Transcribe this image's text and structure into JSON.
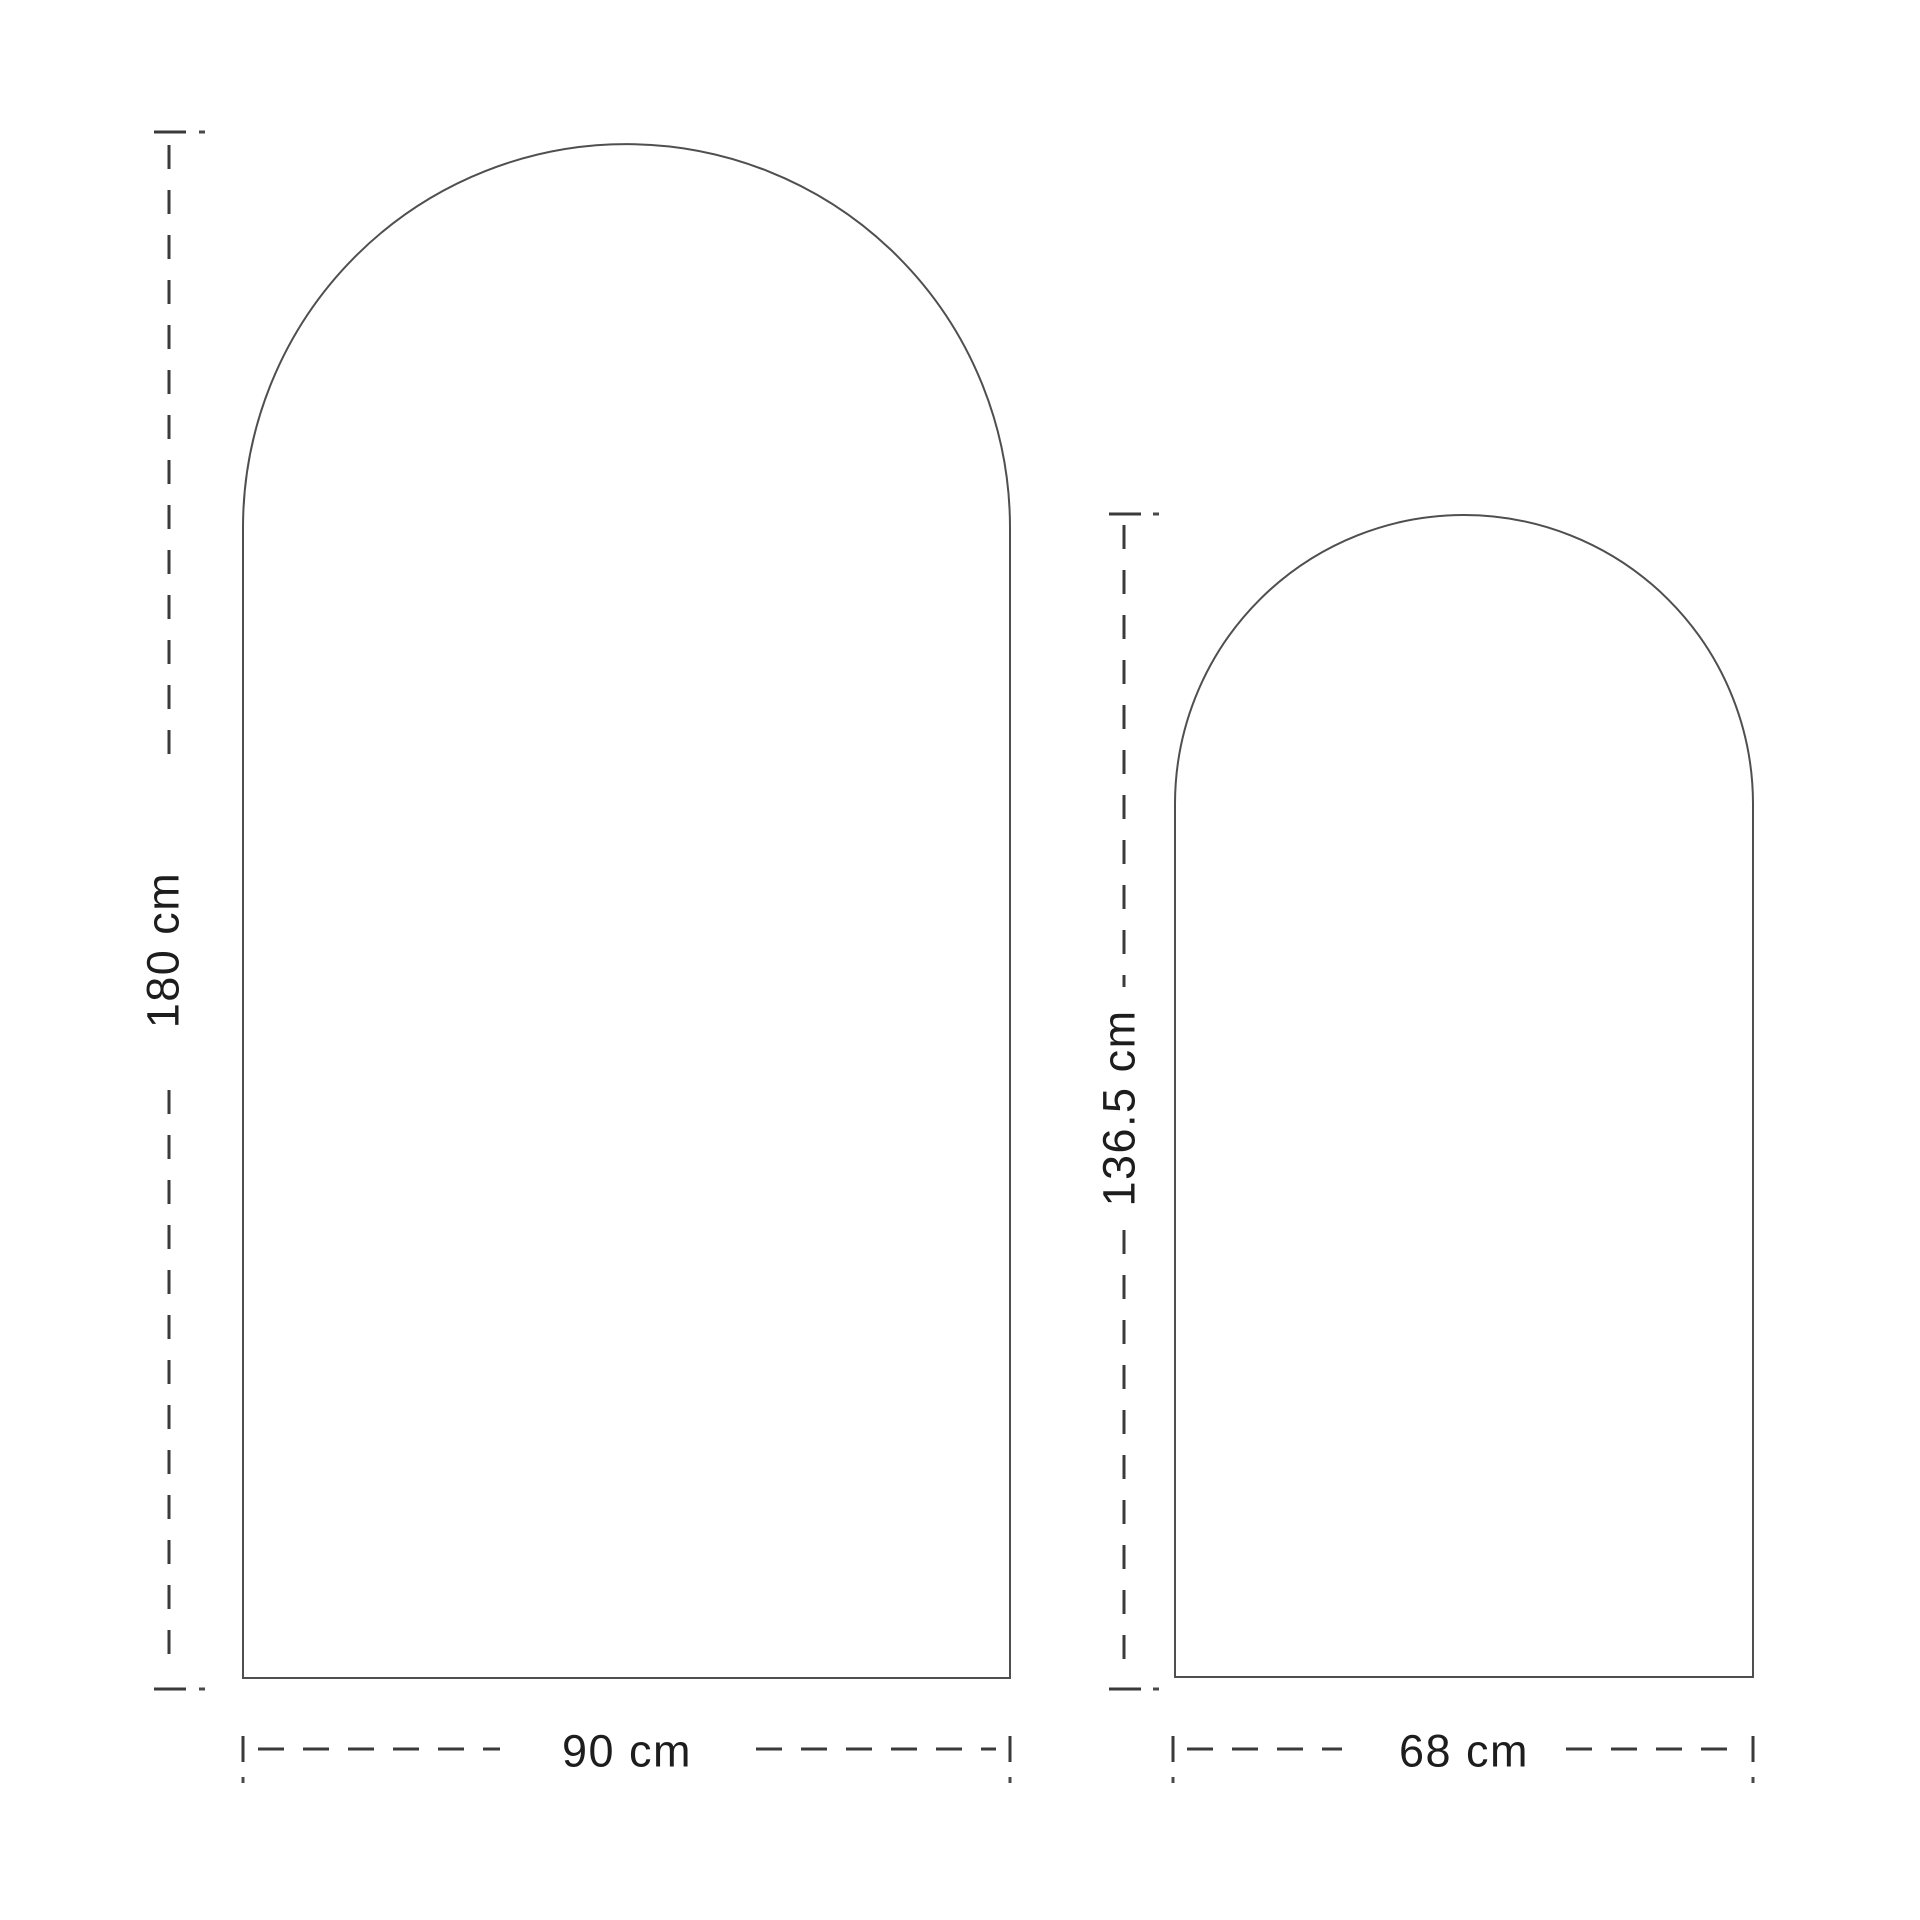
{
  "page": {
    "background_color": "#ffffff",
    "type": "dimension-drawing"
  },
  "diagram": {
    "description": "Two arched panel outlines with dashed dimension lines",
    "stroke_colors": {
      "shape_outline": "#4f4f4f",
      "dimension_line": "#3a3a3a",
      "label_text": "#1d1d1d"
    },
    "large_arch": {
      "name": "large-arch",
      "height_cm": 180,
      "width_cm": 90,
      "height_label": "180 cm",
      "width_label": "90 cm"
    },
    "small_arch": {
      "name": "small-arch",
      "height_cm": 136.5,
      "width_cm": 68,
      "height_label": "136.5 cm",
      "width_label": "68 cm"
    }
  }
}
